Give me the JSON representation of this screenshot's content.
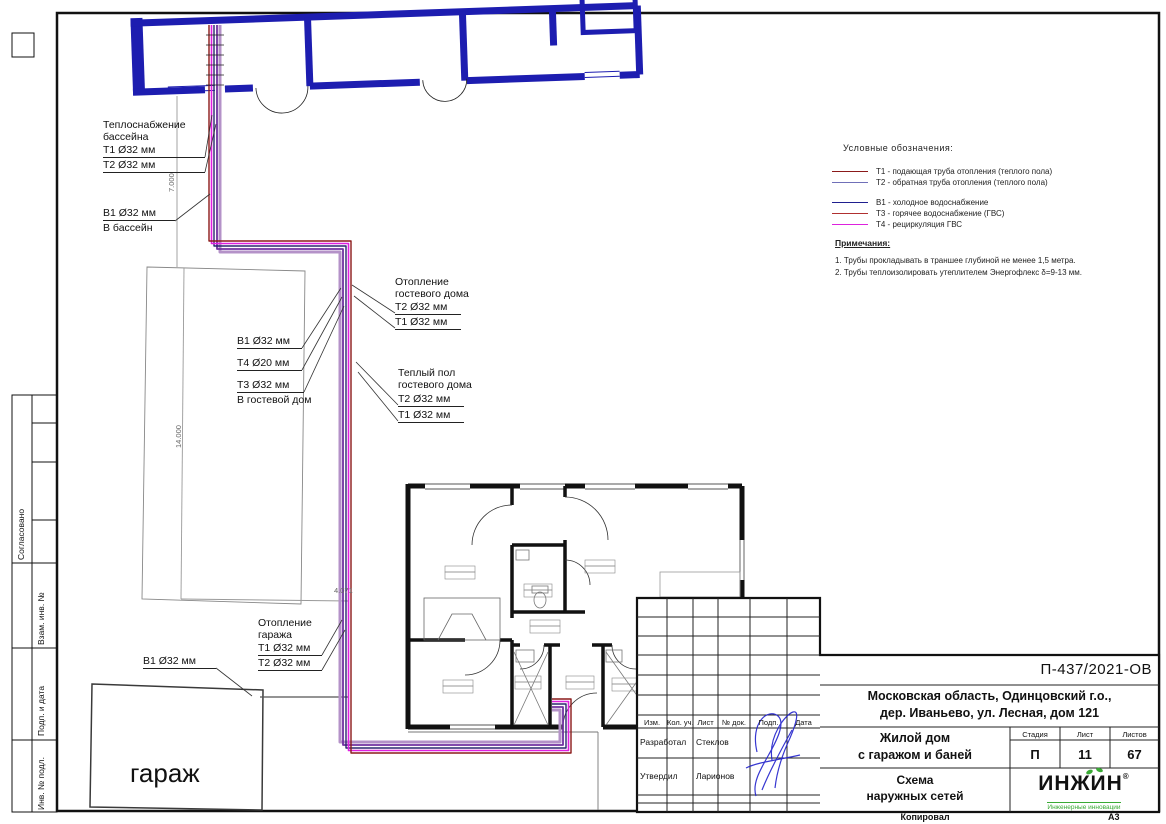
{
  "sheet": {
    "format": "А3",
    "copied": "Копировал"
  },
  "side_stamp": {
    "approved": "Согласовано",
    "replace_inv": "Взам. инв. №",
    "sign_date": "Подп. и дата",
    "inv_orig": "Инв. № подл."
  },
  "labels": {
    "pool_heat": {
      "l1": "Теплоснабжение",
      "l2": "бассейна",
      "s1": "Т1 Ø32 мм",
      "s2": "Т2 Ø32 мм"
    },
    "pool_water": {
      "s1": "В1 Ø32 мм",
      "l1": "В бассейн"
    },
    "guest_heat": {
      "l1": "Отопление",
      "l2": "гостевого дома",
      "s1": "Т2 Ø32 мм",
      "s2": "Т1 Ø32 мм"
    },
    "guest_water": {
      "s1": "В1 Ø32 мм",
      "s2": "Т4 Ø20 мм",
      "s3": "Т3 Ø32 мм",
      "l1": "В гостевой дом"
    },
    "floor_heat": {
      "l1": "Теплый пол",
      "l2": "гостевого дома",
      "s1": "Т2 Ø32 мм",
      "s2": "Т1 Ø32 мм"
    },
    "garage_heat": {
      "l1": "Отопление",
      "l2": "гаража",
      "s1": "Т1 Ø32 мм",
      "s2": "Т2 Ø32 мм"
    },
    "garage_water": {
      "s1": "В1 Ø32 мм"
    },
    "garage": "гараж"
  },
  "dimensions": {
    "v1": "7.000",
    "v2": "14.000",
    "v3": "4.071"
  },
  "legend": {
    "title": "Условные обозначения:",
    "items": [
      {
        "code": "Т1",
        "text": "Т1 - подающая труба отопления (теплого пола)",
        "color": "#8b1a1a"
      },
      {
        "code": "Т2",
        "text": "Т2 - обратная труба отопления (теплого пола)",
        "color": "#7070b8"
      },
      {
        "code": "В1",
        "text": "В1 - холодное водоснабжение",
        "color": "#1f1f8f"
      },
      {
        "code": "Т3",
        "text": "Т3 - горячее водоснабжение (ГВС)",
        "color": "#b03030"
      },
      {
        "code": "Т4",
        "text": "Т4 - рециркуляция ГВС",
        "color": "#dd22dd"
      }
    ],
    "notes_title": "Примечания:",
    "notes": [
      "1.   Трубы прокладывать в траншее глубиной не менее 1,5 метра.",
      "2.   Трубы теплоизолировать утеплителем Энергофлекс δ=9-13 мм."
    ]
  },
  "pipe_colors": {
    "t1_supply": "#8b1a1a",
    "t2_return": "#7030a0",
    "b1_cold": "#28286e",
    "t3_hot": "#e020e0",
    "t4_recirc": "#b492c8"
  },
  "title_block": {
    "doc_number": "П-437/2021-ОВ",
    "address_line1": "Московская область, Одинцовский г.о.,",
    "address_line2": "дер. Иваньево, ул. Лесная, дом 121",
    "object_line1": "Жилой дом",
    "object_line2": "с гаражом и баней",
    "sheet_title_line1": "Схема",
    "sheet_title_line2": "наружных сетей",
    "stage_header": "Стадия",
    "sheet_header": "Лист",
    "sheets_header": "Листов",
    "stage": "П",
    "sheet": "11",
    "sheets": "67",
    "col_headers": [
      "Изм.",
      "Кол. уч.",
      "Лист",
      "№ док.",
      "Подп.",
      "Дата"
    ],
    "row1_role": "Разработал",
    "row1_name": "Стеклов",
    "row2_role": "Утвердил",
    "row2_name": "Ларионов",
    "logo_name": "ИНЖИН",
    "logo_reg": "®",
    "logo_tagline": "Инженерные инновации"
  }
}
